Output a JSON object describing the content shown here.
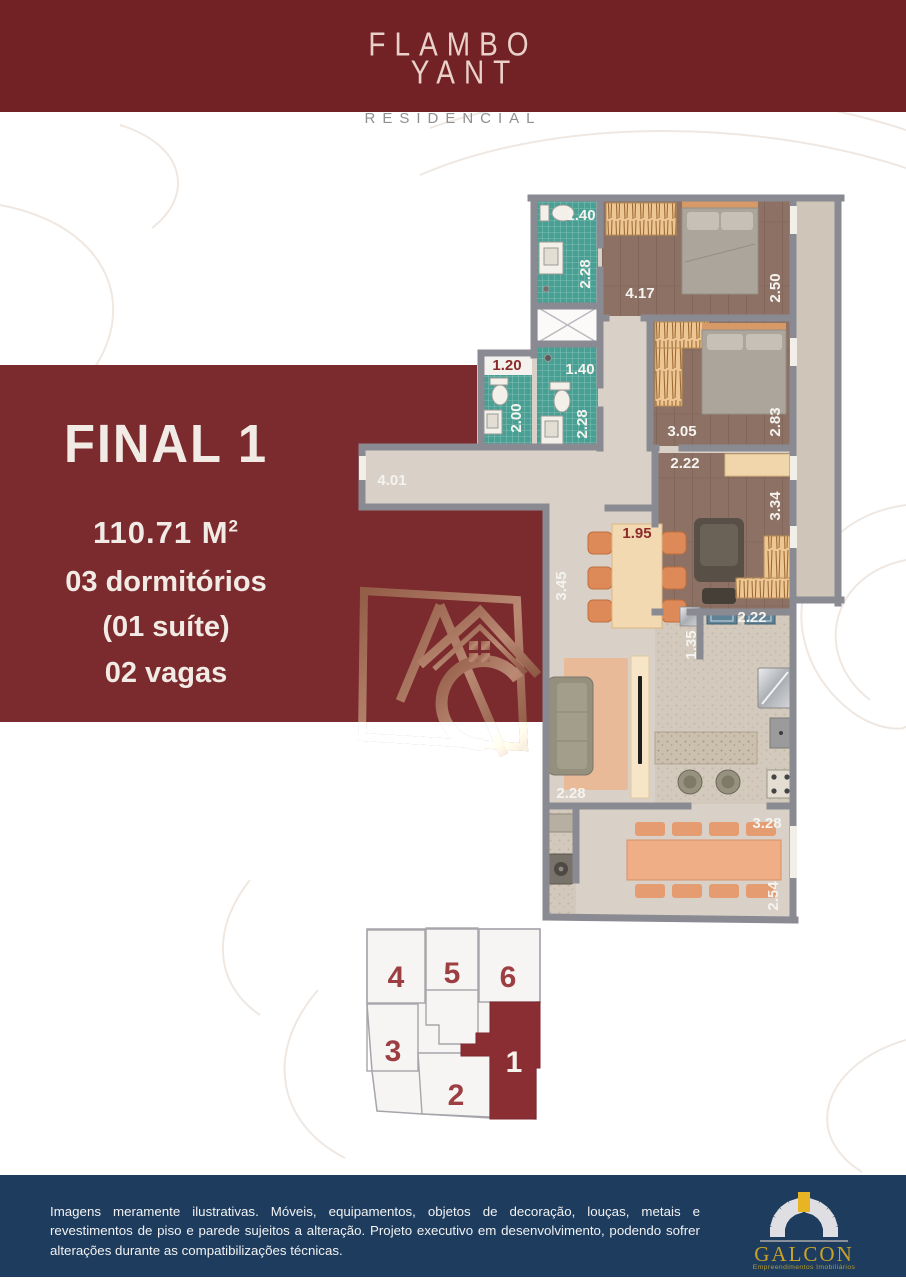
{
  "header": {
    "logo_line1": "FLAMBO",
    "logo_line2": "YANT",
    "subtitle": "RESIDENCIAL"
  },
  "banner": {
    "title": "FINAL 1",
    "area": "110.71 M",
    "area_sup": "2",
    "features": [
      "03 dormitórios",
      "(01 suíte)",
      "02 vagas"
    ]
  },
  "floorplan": {
    "labels": [
      {
        "text": "1.40"
      },
      {
        "text": "2.28"
      },
      {
        "text": "4.17"
      },
      {
        "text": "2.50"
      },
      {
        "text": "1.20"
      },
      {
        "text": "2.00"
      },
      {
        "text": "1.40"
      },
      {
        "text": "2.28"
      },
      {
        "text": "3.05"
      },
      {
        "text": "2.83"
      },
      {
        "text": "2.22"
      },
      {
        "text": "3.34"
      },
      {
        "text": "4.01"
      },
      {
        "text": "3.45"
      },
      {
        "text": "1.95"
      },
      {
        "text": "2.22"
      },
      {
        "text": "1.35"
      },
      {
        "text": "2.28"
      },
      {
        "text": "3.28"
      },
      {
        "text": "2.54"
      }
    ]
  },
  "keyplan": {
    "units": [
      "4",
      "5",
      "6",
      "3",
      "2",
      "1"
    ],
    "highlighted_unit": "1"
  },
  "footer": {
    "disclaimer": "Imagens meramente ilustrativas. Móveis, equipamentos, objetos de decoração, louças, metais e revestimentos de piso e parede sujeitos a alteração. Projeto executivo em desenvolvimento, podendo sofrer alterações durante as compatibilizações técnicas.",
    "brand": "GALCON",
    "brand_tagline": "Empreendimentos Imobiliários"
  },
  "colors": {
    "maroon_header": "#722125",
    "maroon_banner": "#7b2a2d",
    "maroon_unit": "#8b2e34",
    "navy_footer": "#1d3c5e",
    "gold": "#c9a227",
    "teal_tile": "#47a093",
    "label_maroon": "#8c2b2b",
    "wall_gray": "#8a8a92"
  }
}
